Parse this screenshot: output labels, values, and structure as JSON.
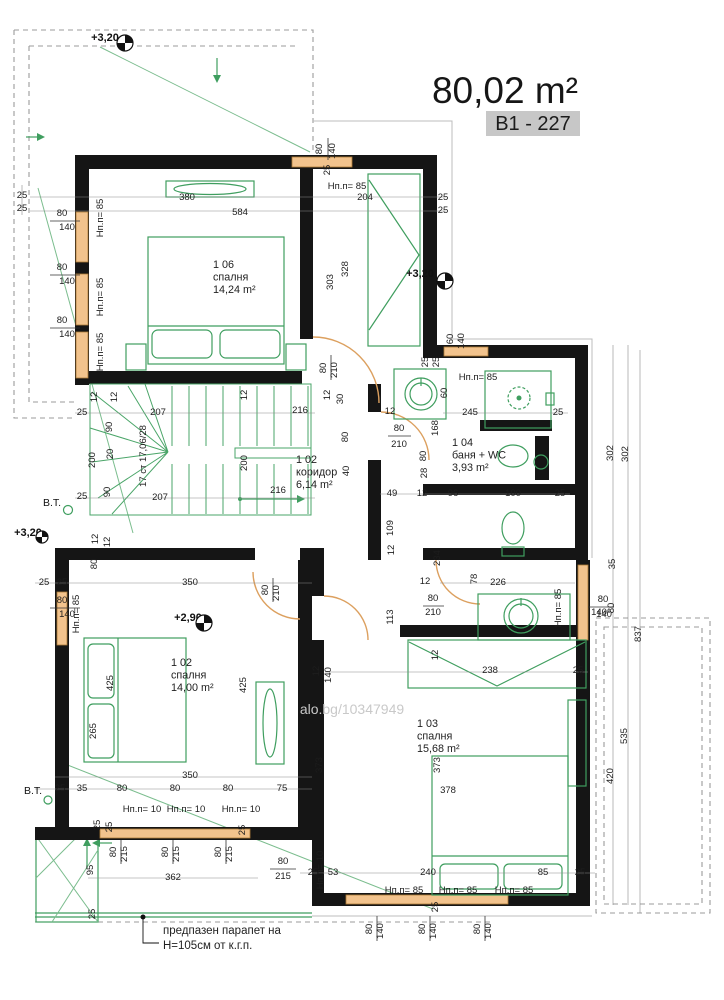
{
  "header": {
    "area_label": "80,02 m²",
    "unit_code": "B1 - 227",
    "code_bg": "#c7c7c7"
  },
  "watermark": "alo.bg/10347949",
  "note": {
    "line1": "предпазен парапет на",
    "line2": "Н=105см от к.г.п."
  },
  "stairs": {
    "label": "17 ст 17,06/28"
  },
  "colors": {
    "wall": "#151515",
    "furniture_green": "#3f9e5f",
    "window_orange": "#f2c38d",
    "dashed_gray": "#9b9b9b"
  },
  "rooms": [
    {
      "id": "1 06",
      "name": "спалня",
      "area": "14,24 m²",
      "x": 213,
      "y": 268
    },
    {
      "id": "1 02",
      "name": "коридор",
      "area": "6,14 m²",
      "x": 296,
      "y": 463
    },
    {
      "id": "1 04",
      "name": "баня + WC",
      "area": "3,93 m²",
      "x": 452,
      "y": 446
    },
    {
      "id": "1 02",
      "name": "спалня",
      "area": "14,00 m²",
      "x": 171,
      "y": 666
    },
    {
      "id": "1 03",
      "name": "спалня",
      "area": "15,68 m²",
      "x": 417,
      "y": 727
    }
  ],
  "elevation_markers": [
    {
      "t": "+3,20",
      "tx": 105,
      "ty": 41,
      "cx": 125,
      "cy": 43,
      "r": 8
    },
    {
      "t": "+3,20",
      "tx": 420,
      "ty": 277,
      "cx": 445,
      "cy": 281,
      "r": 8
    },
    {
      "t": "+3,20",
      "tx": 28,
      "ty": 536,
      "cx": 42,
      "cy": 537,
      "r": 6
    },
    {
      "t": "+2,90",
      "tx": 188,
      "ty": 621,
      "cx": 204,
      "cy": 623,
      "r": 8
    }
  ],
  "bt_labels": [
    {
      "t": "В.Т.",
      "x": 52,
      "y": 506
    },
    {
      "t": "В.Т.",
      "x": 33,
      "y": 794
    }
  ],
  "sill_labels": [
    {
      "t": "Нп.п= 85",
      "x": 103,
      "y": 218,
      "r": -90
    },
    {
      "t": "Нп.п= 85",
      "x": 103,
      "y": 297,
      "r": -90
    },
    {
      "t": "Нп.п= 85",
      "x": 103,
      "y": 352,
      "r": -90
    },
    {
      "t": "Нп.п= 85",
      "x": 347,
      "y": 189
    },
    {
      "t": "Нп.п= 85",
      "x": 478,
      "y": 380
    },
    {
      "t": "Нп.п= 85",
      "x": 561,
      "y": 608,
      "r": -90
    },
    {
      "t": "Нп.п= 85",
      "x": 79,
      "y": 614,
      "r": -90
    },
    {
      "t": "Нп.п= 10",
      "x": 142,
      "y": 812
    },
    {
      "t": "Нп.п= 10",
      "x": 186,
      "y": 812
    },
    {
      "t": "Нп.п= 10",
      "x": 241,
      "y": 812
    },
    {
      "t": "Нп.п= 10",
      "x": 323,
      "y": 870,
      "r": -90
    },
    {
      "t": "Нп.п= 85",
      "x": 404,
      "y": 893
    },
    {
      "t": "Нп.п= 85",
      "x": 458,
      "y": 893
    },
    {
      "t": "Нп.п= 85",
      "x": 514,
      "y": 893
    }
  ],
  "dims": [
    {
      "t": "380",
      "x": 187,
      "y": 200
    },
    {
      "t": "584",
      "x": 240,
      "y": 215
    },
    {
      "t": "204",
      "x": 365,
      "y": 200
    },
    {
      "t": "25",
      "x": 443,
      "y": 200
    },
    {
      "t": "25",
      "x": 443,
      "y": 213
    },
    {
      "t": "25",
      "x": 22,
      "y": 198
    },
    {
      "t": "25",
      "x": 22,
      "y": 211
    },
    {
      "t": "80",
      "x": 62,
      "y": 216
    },
    {
      "t": "140",
      "x": 67,
      "y": 230
    },
    {
      "t": "80",
      "x": 62,
      "y": 270
    },
    {
      "t": "140",
      "x": 67,
      "y": 284
    },
    {
      "t": "80",
      "x": 62,
      "y": 323
    },
    {
      "t": "140",
      "x": 67,
      "y": 337
    },
    {
      "t": "80",
      "x": 322,
      "y": 149,
      "r": -90
    },
    {
      "t": "140",
      "x": 335,
      "y": 151,
      "r": -90
    },
    {
      "t": "25",
      "x": 330,
      "y": 170,
      "r": -90
    },
    {
      "t": "303",
      "x": 333,
      "y": 282,
      "r": -90
    },
    {
      "t": "328",
      "x": 348,
      "y": 269,
      "r": -90
    },
    {
      "t": "60",
      "x": 453,
      "y": 339,
      "r": -90
    },
    {
      "t": "140",
      "x": 464,
      "y": 341,
      "r": -90
    },
    {
      "t": "25",
      "x": 428,
      "y": 362,
      "r": -90
    },
    {
      "t": "25",
      "x": 439,
      "y": 362,
      "r": -90
    },
    {
      "t": "12",
      "x": 330,
      "y": 395,
      "r": -90
    },
    {
      "t": "30",
      "x": 343,
      "y": 399,
      "r": -90
    },
    {
      "t": "80",
      "x": 326,
      "y": 368,
      "r": -90
    },
    {
      "t": "210",
      "x": 337,
      "y": 370,
      "r": -90
    },
    {
      "t": "207",
      "x": 158,
      "y": 415
    },
    {
      "t": "216",
      "x": 300,
      "y": 413
    },
    {
      "t": "12",
      "x": 97,
      "y": 397,
      "r": -90
    },
    {
      "t": "12",
      "x": 117,
      "y": 397,
      "r": -90
    },
    {
      "t": "12",
      "x": 247,
      "y": 395,
      "r": -90
    },
    {
      "t": "25",
      "x": 82,
      "y": 415
    },
    {
      "t": "90",
      "x": 112,
      "y": 427,
      "r": -90
    },
    {
      "t": "20",
      "x": 113,
      "y": 454,
      "r": -90
    },
    {
      "t": "200",
      "x": 95,
      "y": 460,
      "r": -90
    },
    {
      "t": "200",
      "x": 247,
      "y": 463,
      "r": -90
    },
    {
      "t": "90",
      "x": 110,
      "y": 492,
      "r": -90
    },
    {
      "t": "25",
      "x": 82,
      "y": 499
    },
    {
      "t": "207",
      "x": 160,
      "y": 500
    },
    {
      "t": "216",
      "x": 278,
      "y": 493
    },
    {
      "t": "80",
      "x": 348,
      "y": 437,
      "r": -90
    },
    {
      "t": "40",
      "x": 349,
      "y": 471,
      "r": -90
    },
    {
      "t": "80",
      "x": 399,
      "y": 431
    },
    {
      "t": "210",
      "x": 399,
      "y": 447
    },
    {
      "t": "12",
      "x": 390,
      "y": 414
    },
    {
      "t": "28",
      "x": 427,
      "y": 473,
      "r": -90
    },
    {
      "t": "168",
      "x": 438,
      "y": 428,
      "r": -90
    },
    {
      "t": "80",
      "x": 426,
      "y": 456,
      "r": -90
    },
    {
      "t": "49",
      "x": 392,
      "y": 496
    },
    {
      "t": "12",
      "x": 422,
      "y": 496
    },
    {
      "t": "96",
      "x": 453,
      "y": 496
    },
    {
      "t": "100",
      "x": 513,
      "y": 496
    },
    {
      "t": "25",
      "x": 560,
      "y": 496
    },
    {
      "t": "109",
      "x": 393,
      "y": 528,
      "r": -90
    },
    {
      "t": "245",
      "x": 470,
      "y": 415
    },
    {
      "t": "25",
      "x": 558,
      "y": 415
    },
    {
      "t": "60",
      "x": 447,
      "y": 393,
      "r": -90
    },
    {
      "t": "234",
      "x": 440,
      "y": 558,
      "r": -90
    },
    {
      "t": "12",
      "x": 425,
      "y": 584
    },
    {
      "t": "78",
      "x": 477,
      "y": 579,
      "r": -90
    },
    {
      "t": "226",
      "x": 498,
      "y": 585
    },
    {
      "t": "12",
      "x": 394,
      "y": 550,
      "r": -90
    },
    {
      "t": "113",
      "x": 393,
      "y": 617,
      "r": -90
    },
    {
      "t": "80",
      "x": 433,
      "y": 601
    },
    {
      "t": "210",
      "x": 433,
      "y": 615
    },
    {
      "t": "238",
      "x": 490,
      "y": 673
    },
    {
      "t": "25",
      "x": 578,
      "y": 673
    },
    {
      "t": "12",
      "x": 438,
      "y": 655,
      "r": -90
    },
    {
      "t": "140",
      "x": 604,
      "y": 617
    },
    {
      "t": "302",
      "x": 613,
      "y": 453,
      "r": -90
    },
    {
      "t": "302",
      "x": 628,
      "y": 454,
      "r": -90
    },
    {
      "t": "35",
      "x": 615,
      "y": 564,
      "r": -90
    },
    {
      "t": "80",
      "x": 603,
      "y": 602
    },
    {
      "t": "140",
      "x": 599,
      "y": 615
    },
    {
      "t": "80",
      "x": 614,
      "y": 608,
      "r": -90
    },
    {
      "t": "837",
      "x": 641,
      "y": 634,
      "r": -90
    },
    {
      "t": "535",
      "x": 627,
      "y": 736,
      "r": -90
    },
    {
      "t": "420",
      "x": 613,
      "y": 776,
      "r": -90
    },
    {
      "t": "25",
      "x": 44,
      "y": 585
    },
    {
      "t": "25",
      "x": 62,
      "y": 585
    },
    {
      "t": "12",
      "x": 98,
      "y": 539,
      "r": -90
    },
    {
      "t": "12",
      "x": 110,
      "y": 542,
      "r": -90
    },
    {
      "t": "80",
      "x": 97,
      "y": 564,
      "r": -90
    },
    {
      "t": "350",
      "x": 190,
      "y": 585
    },
    {
      "t": "80",
      "x": 268,
      "y": 590,
      "r": -90
    },
    {
      "t": "210",
      "x": 279,
      "y": 593,
      "r": -90
    },
    {
      "t": "80",
      "x": 62,
      "y": 603
    },
    {
      "t": "140",
      "x": 67,
      "y": 617
    },
    {
      "t": "425",
      "x": 113,
      "y": 683,
      "r": -90
    },
    {
      "t": "425",
      "x": 246,
      "y": 685,
      "r": -90
    },
    {
      "t": "265",
      "x": 96,
      "y": 731,
      "r": -90
    },
    {
      "t": "350",
      "x": 190,
      "y": 778
    },
    {
      "t": "25",
      "x": 60,
      "y": 791
    },
    {
      "t": "35",
      "x": 82,
      "y": 791
    },
    {
      "t": "80",
      "x": 122,
      "y": 791
    },
    {
      "t": "80",
      "x": 175,
      "y": 791
    },
    {
      "t": "80",
      "x": 228,
      "y": 791
    },
    {
      "t": "75",
      "x": 282,
      "y": 791
    },
    {
      "t": "25",
      "x": 100,
      "y": 825,
      "r": -90
    },
    {
      "t": "25",
      "x": 112,
      "y": 827,
      "r": -90
    },
    {
      "t": "25",
      "x": 245,
      "y": 830,
      "r": -90
    },
    {
      "t": "80",
      "x": 116,
      "y": 852,
      "r": -90
    },
    {
      "t": "215",
      "x": 127,
      "y": 854,
      "r": -90
    },
    {
      "t": "80",
      "x": 168,
      "y": 852,
      "r": -90
    },
    {
      "t": "215",
      "x": 179,
      "y": 854,
      "r": -90
    },
    {
      "t": "80",
      "x": 221,
      "y": 852,
      "r": -90
    },
    {
      "t": "215",
      "x": 232,
      "y": 854,
      "r": -90
    },
    {
      "t": "95",
      "x": 93,
      "y": 870,
      "r": -90
    },
    {
      "t": "362",
      "x": 173,
      "y": 880
    },
    {
      "t": "80",
      "x": 283,
      "y": 864
    },
    {
      "t": "215",
      "x": 283,
      "y": 879
    },
    {
      "t": "25",
      "x": 95,
      "y": 914,
      "r": -90
    },
    {
      "t": "373",
      "x": 322,
      "y": 765,
      "r": -90
    },
    {
      "t": "373",
      "x": 440,
      "y": 765,
      "r": -90
    },
    {
      "t": "378",
      "x": 448,
      "y": 793
    },
    {
      "t": "12",
      "x": 319,
      "y": 671,
      "r": -90
    },
    {
      "t": "140",
      "x": 331,
      "y": 675,
      "r": -90
    },
    {
      "t": "25",
      "x": 313,
      "y": 875
    },
    {
      "t": "53",
      "x": 333,
      "y": 875
    },
    {
      "t": "240",
      "x": 428,
      "y": 875
    },
    {
      "t": "85",
      "x": 543,
      "y": 875
    },
    {
      "t": "25",
      "x": 580,
      "y": 875
    },
    {
      "t": "25",
      "x": 438,
      "y": 907,
      "r": -90
    },
    {
      "t": "80",
      "x": 372,
      "y": 929,
      "r": -90
    },
    {
      "t": "140",
      "x": 383,
      "y": 931,
      "r": -90
    },
    {
      "t": "80",
      "x": 425,
      "y": 929,
      "r": -90
    },
    {
      "t": "140",
      "x": 436,
      "y": 931,
      "r": -90
    },
    {
      "t": "80",
      "x": 480,
      "y": 929,
      "r": -90
    },
    {
      "t": "140",
      "x": 491,
      "y": 931,
      "r": -90
    }
  ]
}
